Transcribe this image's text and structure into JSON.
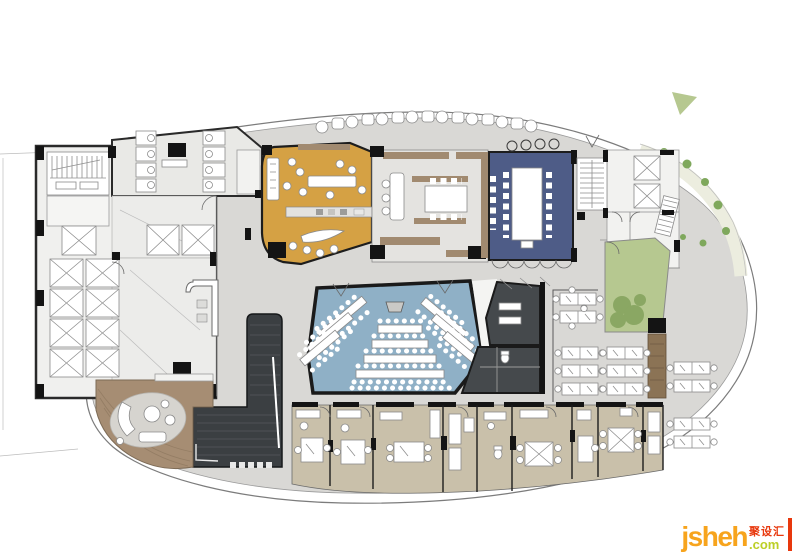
{
  "watermark": {
    "brand": "jsheh",
    "tld": ".com",
    "cn_label": "聚设汇"
  },
  "palette": {
    "floor": "#d9d8d5",
    "marble": "#ececea",
    "restroom": "#e9e9e6",
    "orange_room": "#d5a144",
    "wood": "#a18a70",
    "blue_room": "#4e5c87",
    "auditorium": "#8fb0c6",
    "dark_room": "#45494c",
    "dark_bar": "#3b3f42",
    "beige_office": "#c9c0aa",
    "deck": "#a68d73",
    "green_court": "#b6c890",
    "green_bush": "#8aa763",
    "plant_green": "#7fa85c",
    "watermark_orange": "#f7a41d",
    "watermark_green": "#bccf27",
    "watermark_red": "#e8380d"
  }
}
